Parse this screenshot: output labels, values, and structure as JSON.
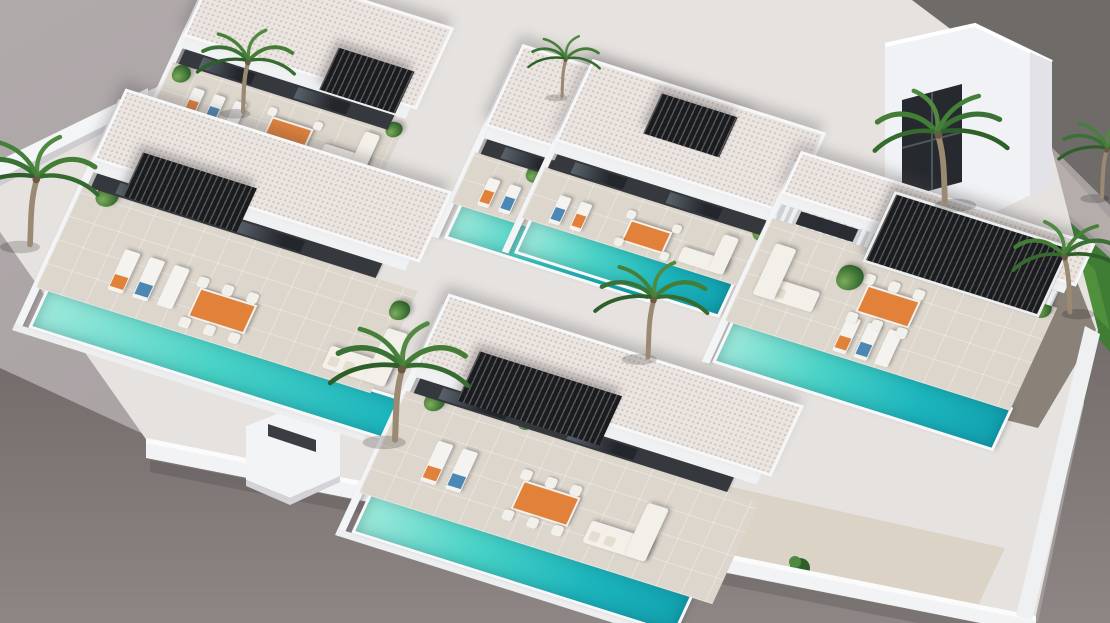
{
  "scene": {
    "type": "3d-architectural-render",
    "subject": "Aerial isometric rendering of a new-build development of six modern white villas, each with a private pool, sun terrace, black slatted pergola and outdoor furniture",
    "view": "high-angle aerial from the south-west, plain studio backdrop",
    "environment": {
      "backdrop": "plain warm grey",
      "street": "dark asphalt strip at top-right corner with light sidewalk",
      "grass_verge": "green strip with palm trees along right boundary wall",
      "ground": "bare grey terrain in the left and bottom foreground"
    },
    "palette": {
      "backdrop": "#a9a2a3",
      "ground": "#7d7674",
      "road": "#6f6b69",
      "sidewalk": "#b4adaa",
      "grass": "#3f7d35",
      "white_wall": "#f2f3f5",
      "wall_shade": "#cfcdd2",
      "roof": "#ebe5e1",
      "terrace": "#dcd6cc",
      "facade": "#35383d",
      "pergola": "#1b1c1f",
      "pool_light": "#9fe9da",
      "pool_deep": "#12a2b0",
      "accent_orange": "#e2813a",
      "accent_blue": "#4d88b4",
      "plant_green": "#3f7434",
      "paving_dark": "#8a8278",
      "sand_court": "#dbd3c6"
    },
    "inventory": {
      "villas": 6,
      "swimming_pools": 6,
      "pergolas": 6,
      "sun_loungers": 15,
      "dining_sets": 6,
      "corner_sofas": 6,
      "palm_trees": 8,
      "potted_plants": 10,
      "two_storey_tower": 1,
      "street_entrance_kiosk": 1
    },
    "villas": [
      {
        "id": 1,
        "position": "back-left",
        "features": [
          "pool",
          "terrace",
          "pergola",
          "loungers",
          "dining-set",
          "sofa"
        ]
      },
      {
        "id": 2,
        "position": "back-center",
        "features": [
          "pool",
          "terrace",
          "pergola",
          "loungers",
          "dining-set",
          "sofa"
        ]
      },
      {
        "id": 3,
        "position": "back-right",
        "features": [
          "pool",
          "terrace",
          "pergola",
          "loungers",
          "dining-set",
          "sofa"
        ]
      },
      {
        "id": 4,
        "position": "front-left",
        "features": [
          "pool",
          "terrace",
          "pergola",
          "loungers",
          "dining-set",
          "sofa"
        ]
      },
      {
        "id": 5,
        "position": "front-center",
        "features": [
          "pool",
          "terrace",
          "pergola",
          "loungers",
          "dining-set",
          "sofa"
        ]
      },
      {
        "id": 6,
        "position": "right-with-tower",
        "features": [
          "pool",
          "terrace",
          "framed-pergola",
          "loungers",
          "dining-set",
          "sofa",
          "roof-tower"
        ]
      }
    ]
  }
}
